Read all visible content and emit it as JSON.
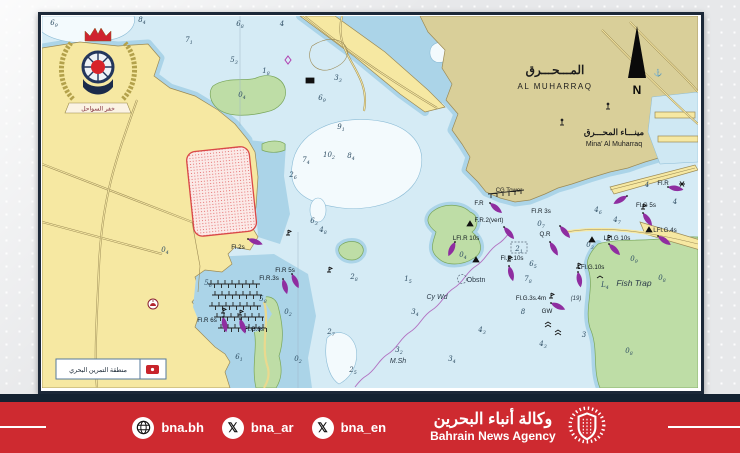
{
  "chart": {
    "title_ar": "المـــحـــرق",
    "title_en": "AL MUHARRAQ",
    "port_ar": "مينـــاء المحـــرق",
    "port_en": "Mina' Al Muharraq",
    "cg_tower": "CG Tower",
    "north_label": "N",
    "exercise_area_ar": "منطقة التمرين البحري",
    "emblem_banner_ar": "خفر السواحل",
    "anchor_symbol": "⚓",
    "boxed_sounding": {
      "d": "2",
      "s": "1",
      "x": 477,
      "y": 235
    },
    "colors": {
      "land": "#f6e8a2",
      "builtup_land": "#d9cf99",
      "sea_light": "#d5ebf5",
      "sea_mid": "#abd4e8",
      "deep_white": "#f3fafd",
      "tidal_green": "#bedda6",
      "restricted_red": "#d94848",
      "light_magenta": "#8f2da0",
      "frame": "#1c2838",
      "footer_red": "#ce2a30",
      "footer_navy": "#142231"
    },
    "place_labels": [
      {
        "text": "CG Tower",
        "x": 467,
        "y": 176,
        "size": 6,
        "bold": false,
        "ls": 0
      }
    ],
    "seabed_labels": [
      {
        "text": "Obstn",
        "x": 434,
        "y": 266,
        "italic": false,
        "size": 7
      },
      {
        "text": "Cy Wd",
        "x": 395,
        "y": 283,
        "italic": true,
        "size": 7
      },
      {
        "text": "M.Sh",
        "x": 356,
        "y": 347,
        "italic": true,
        "size": 7
      },
      {
        "text": "Fish Trap",
        "x": 592,
        "y": 270,
        "italic": true,
        "size": 8.5
      },
      {
        "text": "(19)",
        "x": 534,
        "y": 284,
        "italic": true,
        "size": 6
      }
    ],
    "light_labels": [
      {
        "text": "Fl.2s",
        "x": 196,
        "y": 233,
        "size": 6.5
      },
      {
        "text": "Fl.R 5s",
        "x": 243,
        "y": 256,
        "size": 6.2
      },
      {
        "text": "Fl.R.3s",
        "x": 227,
        "y": 264,
        "size": 6.2
      },
      {
        "text": "Fl.R 6s",
        "x": 165,
        "y": 306,
        "size": 6.2
      },
      {
        "text": "Fl.G.6s",
        "x": 212,
        "y": 315,
        "size": 6.2
      },
      {
        "text": "F.R",
        "x": 437,
        "y": 189,
        "size": 6
      },
      {
        "text": "Fl.R 3s",
        "x": 499,
        "y": 197,
        "size": 6.2
      },
      {
        "text": "F.R.2(vert)",
        "x": 447,
        "y": 206,
        "size": 6
      },
      {
        "text": "Q.R",
        "x": 503,
        "y": 220,
        "size": 6
      },
      {
        "text": "Fl.R.10s",
        "x": 470,
        "y": 244,
        "size": 6.2
      },
      {
        "text": "LFl.R 10s",
        "x": 424,
        "y": 224,
        "size": 5
      },
      {
        "text": "Fl.G.3s.4m",
        "x": 489,
        "y": 284,
        "size": 6.2
      },
      {
        "text": "LFl.G.10s",
        "x": 549,
        "y": 253,
        "size": 5
      },
      {
        "text": "LFl.G 10s",
        "x": 575,
        "y": 224,
        "size": 5
      },
      {
        "text": "Fl.G 5s",
        "x": 604,
        "y": 191,
        "size": 6.2
      },
      {
        "text": "Fl.R",
        "x": 621,
        "y": 169,
        "size": 6
      },
      {
        "text": "LFl.G.4s",
        "x": 623,
        "y": 216,
        "size": 5
      },
      {
        "text": "GW",
        "x": 505,
        "y": 297,
        "size": 4
      }
    ],
    "soundings": [
      {
        "d": "6",
        "s": "9",
        "x": 12,
        "y": 9
      },
      {
        "d": "8",
        "s": "4",
        "x": 100,
        "y": 6
      },
      {
        "d": "7",
        "s": "1",
        "x": 147,
        "y": 26
      },
      {
        "d": "6",
        "s": "8",
        "x": 198,
        "y": 10
      },
      {
        "d": "4",
        "s": "",
        "x": 240,
        "y": 10
      },
      {
        "d": "5",
        "s": "3",
        "x": 192,
        "y": 46
      },
      {
        "d": "1",
        "s": "8",
        "x": 224,
        "y": 57
      },
      {
        "d": "0",
        "s": "4",
        "x": 200,
        "y": 81
      },
      {
        "d": "3",
        "s": "3",
        "x": 296,
        "y": 64
      },
      {
        "d": "6",
        "s": "9",
        "x": 280,
        "y": 84
      },
      {
        "d": "7",
        "s": "4",
        "x": 264,
        "y": 146
      },
      {
        "d": "10",
        "s": "2",
        "x": 287,
        "y": 141
      },
      {
        "d": "8",
        "s": "4",
        "x": 309,
        "y": 142
      },
      {
        "d": "9",
        "s": "1",
        "x": 299,
        "y": 113
      },
      {
        "d": "2",
        "s": "6",
        "x": 251,
        "y": 161
      },
      {
        "d": "6",
        "s": "3",
        "x": 272,
        "y": 207
      },
      {
        "d": "4",
        "s": "8",
        "x": 281,
        "y": 216
      },
      {
        "d": "5",
        "s": "6",
        "x": 166,
        "y": 269
      },
      {
        "d": "5",
        "s": "8",
        "x": 221,
        "y": 285
      },
      {
        "d": "6",
        "s": "1",
        "x": 197,
        "y": 343
      },
      {
        "d": "2",
        "s": "7",
        "x": 289,
        "y": 318
      },
      {
        "d": "0",
        "s": "2",
        "x": 256,
        "y": 345
      },
      {
        "d": "3",
        "s": "4",
        "x": 373,
        "y": 298
      },
      {
        "d": "3",
        "s": "2",
        "x": 357,
        "y": 336
      },
      {
        "d": "3",
        "s": "4",
        "x": 410,
        "y": 345
      },
      {
        "d": "2",
        "s": "5",
        "x": 311,
        "y": 356
      },
      {
        "d": "2",
        "s": "8",
        "x": 312,
        "y": 263
      },
      {
        "d": "1",
        "s": "5",
        "x": 366,
        "y": 265
      },
      {
        "d": "4",
        "s": "3",
        "x": 440,
        "y": 316
      },
      {
        "d": "6",
        "s": "5",
        "x": 491,
        "y": 250
      },
      {
        "d": "7",
        "s": "8",
        "x": 486,
        "y": 265
      },
      {
        "d": "8",
        "s": "",
        "x": 481,
        "y": 298
      },
      {
        "d": "3",
        "s": "",
        "x": 542,
        "y": 321
      },
      {
        "d": "0",
        "s": "8",
        "x": 587,
        "y": 337
      },
      {
        "d": "4",
        "s": "3",
        "x": 501,
        "y": 330
      },
      {
        "d": "0",
        "s": "9",
        "x": 592,
        "y": 245
      },
      {
        "d": "0",
        "s": "8",
        "x": 620,
        "y": 264
      },
      {
        "d": "L",
        "s": "4",
        "x": 563,
        "y": 271
      },
      {
        "d": "4",
        "s": "6",
        "x": 556,
        "y": 196
      },
      {
        "d": "0",
        "s": "7",
        "x": 499,
        "y": 210
      },
      {
        "d": "4",
        "s": "7",
        "x": 575,
        "y": 206
      },
      {
        "d": "4",
        "s": "",
        "x": 633,
        "y": 188
      },
      {
        "d": "4",
        "s": "",
        "x": 605,
        "y": 171
      },
      {
        "d": "0",
        "s": "3",
        "x": 548,
        "y": 231
      },
      {
        "d": "0",
        "s": "4",
        "x": 421,
        "y": 241
      },
      {
        "d": "0",
        "s": "4",
        "x": 123,
        "y": 236
      },
      {
        "d": "0",
        "s": "2",
        "x": 246,
        "y": 298
      }
    ],
    "flares": [
      {
        "x": 206,
        "y": 223,
        "a": -70
      },
      {
        "x": 250,
        "y": 258,
        "a": -25
      },
      {
        "x": 241,
        "y": 263,
        "a": -15
      },
      {
        "x": 181,
        "y": 301,
        "a": -12
      },
      {
        "x": 198,
        "y": 303,
        "a": -20
      },
      {
        "x": 448,
        "y": 187,
        "a": -50
      },
      {
        "x": 462,
        "y": 211,
        "a": -40
      },
      {
        "x": 518,
        "y": 210,
        "a": -40
      },
      {
        "x": 508,
        "y": 226,
        "a": -30
      },
      {
        "x": 413,
        "y": 226,
        "a": 25
      },
      {
        "x": 467,
        "y": 250,
        "a": -15
      },
      {
        "x": 509,
        "y": 287,
        "a": -65
      },
      {
        "x": 536,
        "y": 256,
        "a": -10
      },
      {
        "x": 567,
        "y": 228,
        "a": -45
      },
      {
        "x": 585,
        "y": 180,
        "a": 60
      },
      {
        "x": 601,
        "y": 197,
        "a": -35
      },
      {
        "x": 626,
        "y": 171,
        "a": -80
      },
      {
        "x": 616,
        "y": 220,
        "a": -55
      }
    ],
    "beacons": [
      {
        "x": 550,
        "y": 226,
        "t": "cone"
      },
      {
        "x": 607,
        "y": 216,
        "t": "cone"
      },
      {
        "x": 428,
        "y": 210,
        "t": "cone"
      },
      {
        "x": 434,
        "y": 246,
        "t": "cone"
      },
      {
        "x": 246,
        "y": 219,
        "t": "mast"
      },
      {
        "x": 287,
        "y": 256,
        "t": "mast"
      },
      {
        "x": 181,
        "y": 297,
        "t": "mast"
      },
      {
        "x": 198,
        "y": 299,
        "t": "mast"
      },
      {
        "x": 509,
        "y": 282,
        "t": "mast"
      },
      {
        "x": 640,
        "y": 168,
        "t": "star"
      },
      {
        "x": 467,
        "y": 245,
        "t": "mast"
      },
      {
        "x": 536,
        "y": 252,
        "t": "mast"
      },
      {
        "x": 566,
        "y": 224,
        "t": "mast"
      },
      {
        "x": 601,
        "y": 193,
        "t": "mast"
      }
    ]
  },
  "footer": {
    "links": [
      {
        "label": "bna.bh",
        "icon": "globe-icon"
      },
      {
        "label": "bna_ar",
        "icon": "x-icon"
      },
      {
        "label": "bna_en",
        "icon": "x-icon"
      }
    ],
    "agency_ar": "وكالة أنباء البحرين",
    "agency_en": "Bahrain News Agency"
  }
}
